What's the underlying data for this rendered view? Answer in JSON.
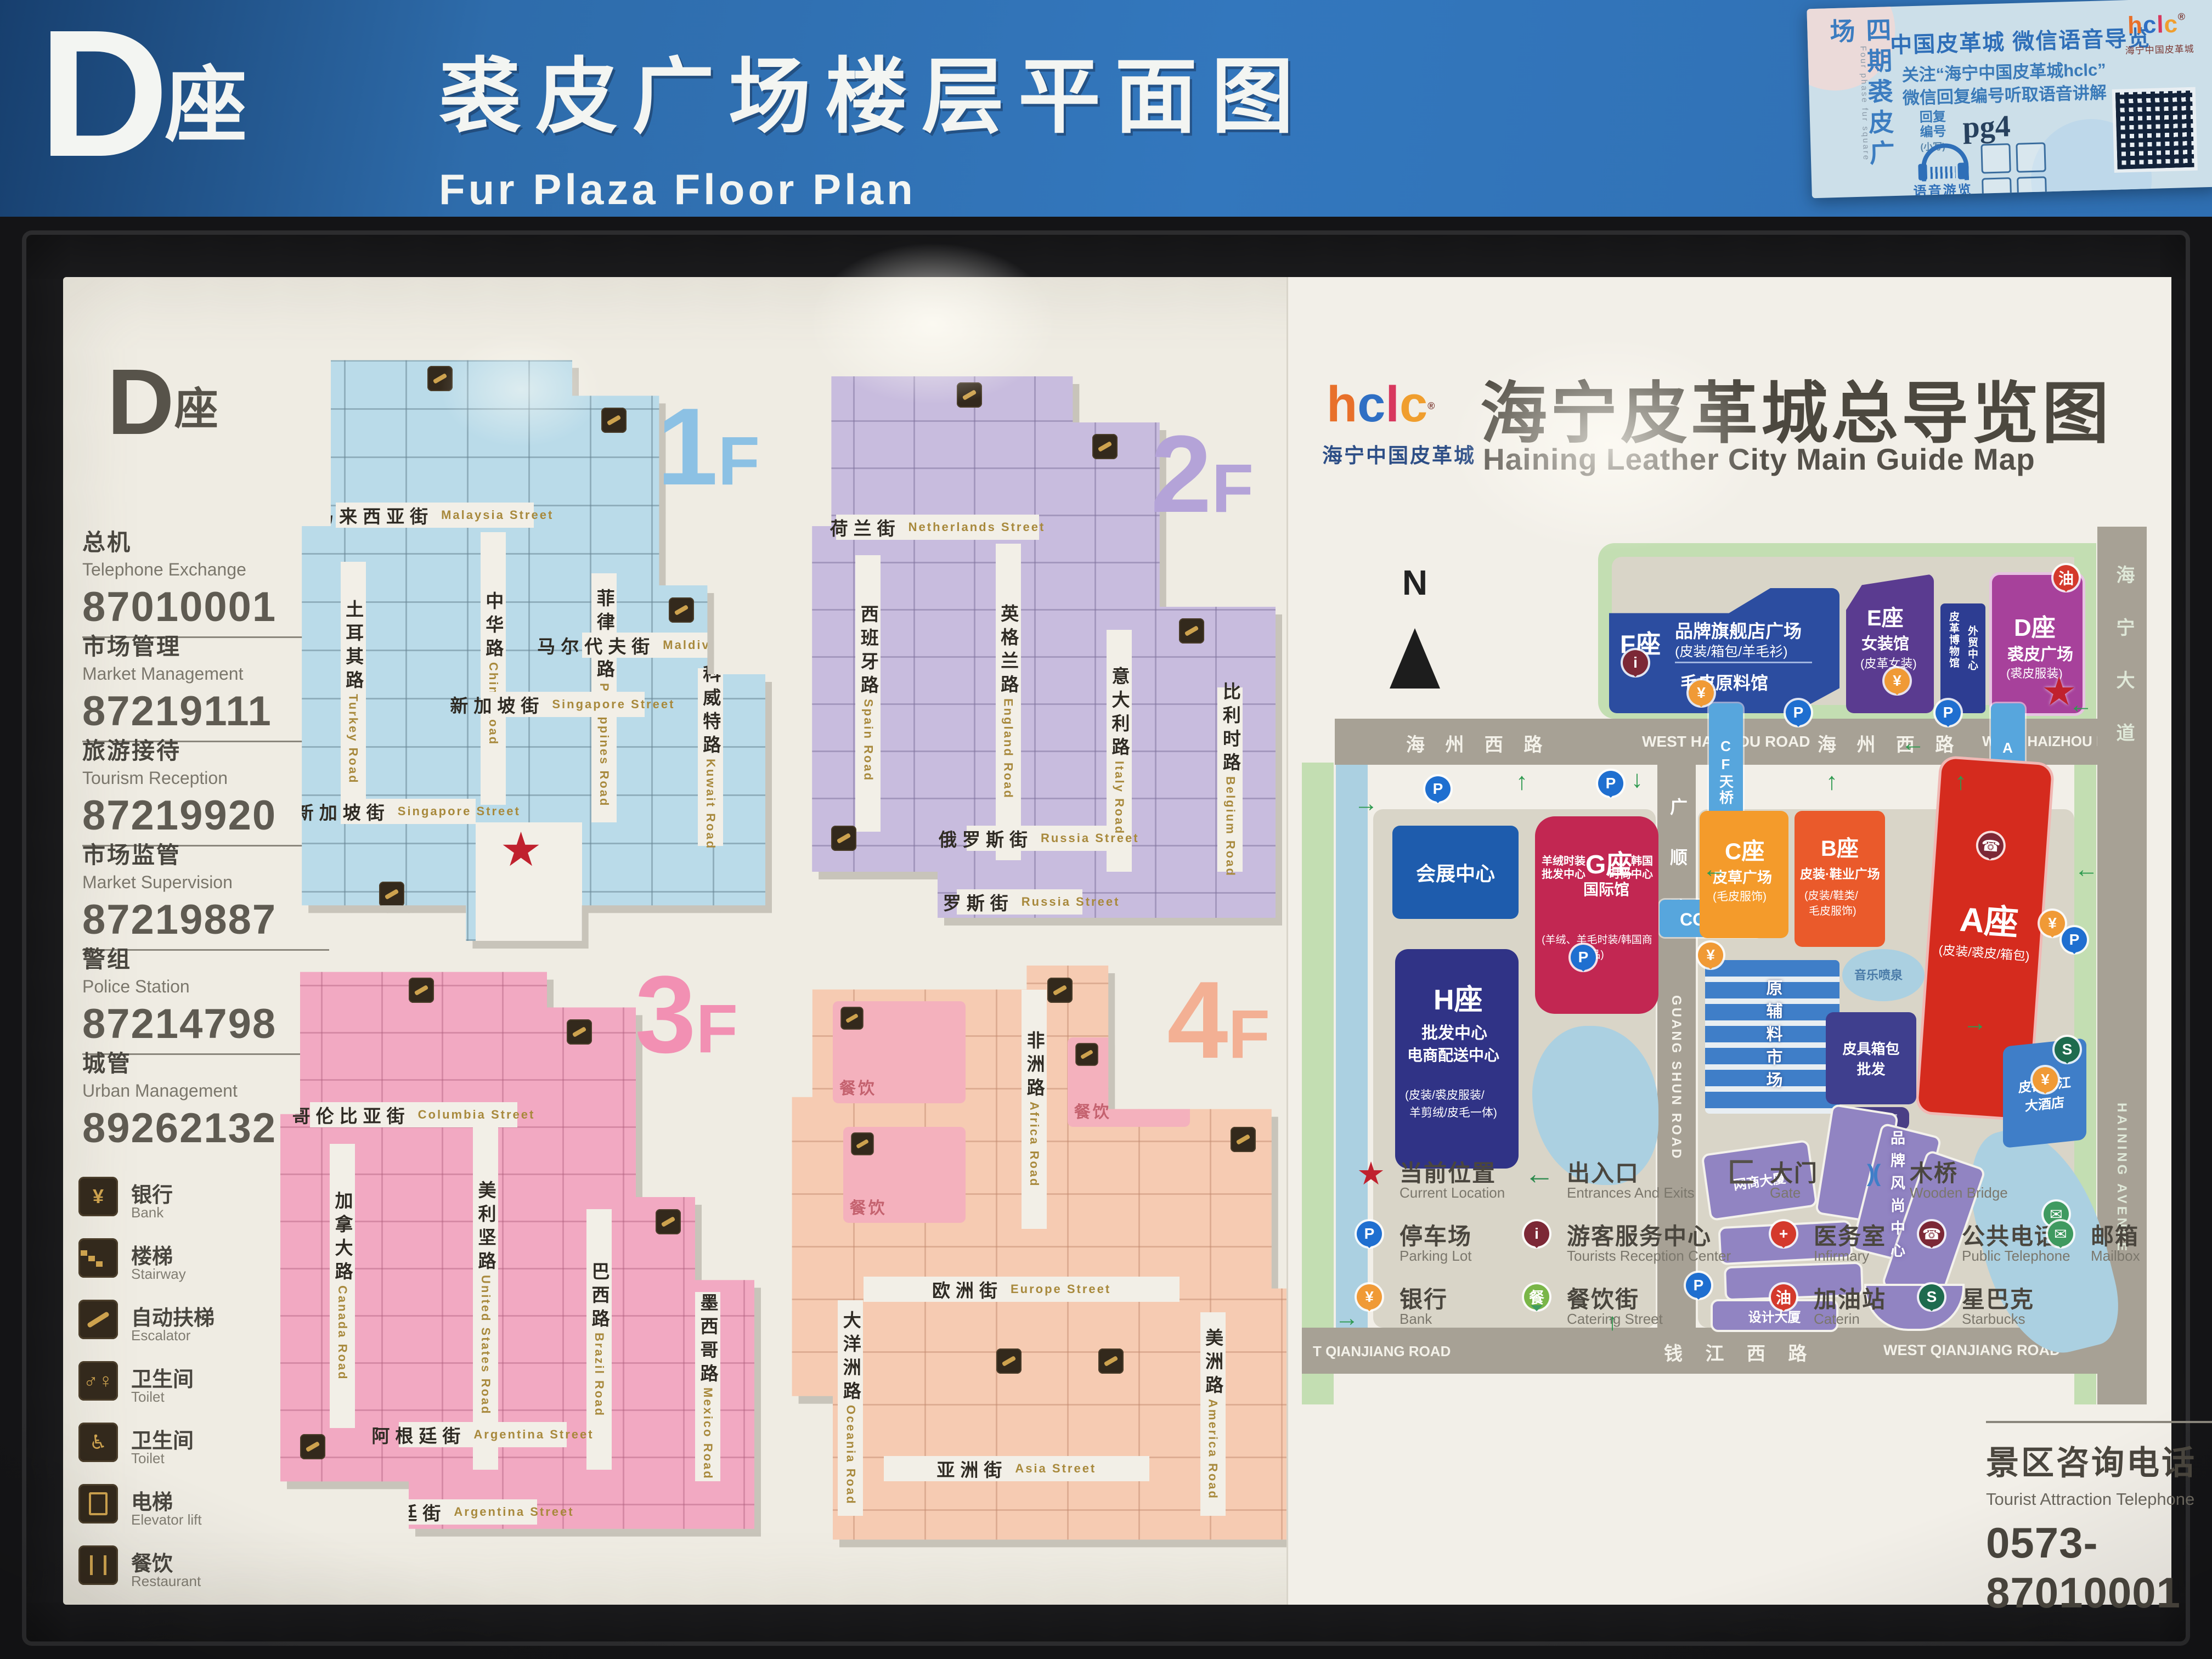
{
  "header": {
    "letter": "D",
    "suffix": "座",
    "title_zh": "裘皮广场楼层平面图",
    "title_en": "Fur Plaza  Floor Plan"
  },
  "brand": {
    "chars": [
      "h",
      "c",
      "l",
      "c"
    ],
    "reg": "®",
    "name_zh": "海宁中国皮革城"
  },
  "info_card": {
    "side_zh": "四期裘皮广场",
    "side_en": "Four  phase  fur  square",
    "title": "中国皮革城 微信语音导览",
    "line1": "关注“海宁中国皮革城hclc”",
    "line2": "微信回复编号听取语音讲解",
    "reply1": "回复",
    "reply2": "编号",
    "note": "(小写)",
    "code": "pg4",
    "audio": "语音游览"
  },
  "sidebar": {
    "letter": "D",
    "suffix": "座",
    "contacts": [
      {
        "zh": "总机",
        "en": "Telephone Exchange",
        "tel": "87010001"
      },
      {
        "zh": "市场管理",
        "en": "Market Management",
        "tel": "87219111"
      },
      {
        "zh": "旅游接待",
        "en": "Tourism Reception",
        "tel": "87219920"
      },
      {
        "zh": "市场监管",
        "en": "Market Supervision",
        "tel": "87219887"
      },
      {
        "zh": "警组",
        "en": "Police Station",
        "tel": "87214798"
      },
      {
        "zh": "城管",
        "en": "Urban Management",
        "tel": "89262132"
      }
    ],
    "legend": [
      {
        "zh": "银行",
        "en": "Bank"
      },
      {
        "zh": "楼梯",
        "en": "Stairway"
      },
      {
        "zh": "自动扶梯",
        "en": "Escalator"
      },
      {
        "zh": "卫生间",
        "en": "Toilet"
      },
      {
        "zh": "卫生间",
        "en": "Toilet"
      },
      {
        "zh": "电梯",
        "en": "Elevator lift"
      },
      {
        "zh": "餐饮",
        "en": "Restaurant"
      }
    ]
  },
  "floors": [
    {
      "num": "1",
      "suffix": "F",
      "streets": [
        {
          "zh": "马来西亚街",
          "en": "Malaysia Street"
        },
        {
          "zh": "土耳其路",
          "en": "Turkey Road"
        },
        {
          "zh": "中华路",
          "en": "China Road"
        },
        {
          "zh": "菲律宾路",
          "en": "Philippines Road"
        },
        {
          "zh": "马尔代夫街",
          "en": "Maldives Street"
        },
        {
          "zh": "科威特路",
          "en": "Kuwait Road"
        },
        {
          "zh": "新加坡街",
          "en": "Singapore Street"
        },
        {
          "zh": "新加坡街",
          "en": "Singapore Street"
        }
      ]
    },
    {
      "num": "2",
      "suffix": "F",
      "streets": [
        {
          "zh": "荷兰街",
          "en": "Netherlands Street"
        },
        {
          "zh": "西班牙路",
          "en": "Spain Road"
        },
        {
          "zh": "英格兰路",
          "en": "England Road"
        },
        {
          "zh": "意大利路",
          "en": "Italy Road"
        },
        {
          "zh": "比利时路",
          "en": "Belgium Road"
        },
        {
          "zh": "俄罗斯街",
          "en": "Russia Street"
        },
        {
          "zh": "俄罗斯街",
          "en": "Russia Street"
        }
      ]
    },
    {
      "num": "3",
      "suffix": "F",
      "streets": [
        {
          "zh": "哥伦比亚街",
          "en": "Columbia Street"
        },
        {
          "zh": "加拿大路",
          "en": "Canada Road"
        },
        {
          "zh": "美利坚路",
          "en": "United States Road"
        },
        {
          "zh": "巴西路",
          "en": "Brazil Road"
        },
        {
          "zh": "墨西哥路",
          "en": "Mexico Road"
        },
        {
          "zh": "阿根廷街",
          "en": "Argentina Street"
        },
        {
          "zh": "阿根廷街",
          "en": "Argentina Street"
        }
      ]
    },
    {
      "num": "4",
      "suffix": "F",
      "food_label": "餐饮",
      "streets": [
        {
          "zh": "非洲路",
          "en": "Africa Road"
        },
        {
          "zh": "欧洲街",
          "en": "Europe Street"
        },
        {
          "zh": "大洋洲路",
          "en": "Oceania Road"
        },
        {
          "zh": "美洲路",
          "en": "America Road"
        },
        {
          "zh": "亚洲街",
          "en": "Asia Street"
        }
      ]
    }
  ],
  "guide": {
    "title_zh": "海宁皮革城总导览图",
    "title_en": "Haining Leather City Main Guide Map",
    "north": "N",
    "roads": {
      "haizhou_zh": "海 州 西 路",
      "haizhou_en": "WEST HAIZHOU ROAD",
      "qianjiang_zh": "钱 江 西 路",
      "qianjiang_en": "WEST QIANJIANG ROAD",
      "qianjiang_partial": "T QIANJIANG ROAD",
      "guangshun_zh": "广 顺 路",
      "guangshun_en": "GUANG SHUN ROAD",
      "haining_zh": "海 宁 大 道",
      "haining_en": "HAINING AVENUE"
    },
    "bridges": {
      "cf": "CF天桥",
      "ad": "AD天桥",
      "cg": "CG天桥"
    },
    "buildings": {
      "f": {
        "name": "F座",
        "line1": "品牌旗舰店广场",
        "line2": "(皮装/箱包/羊毛衫)",
        "line3": "毛皮原料馆"
      },
      "e": {
        "name": "E座",
        "line1": "女装馆",
        "line2": "(皮革女装)"
      },
      "museum": {
        "line1": "皮革博物馆",
        "line2": "外贸中心"
      },
      "d": {
        "name": "D座",
        "line1": "裘皮广场",
        "line2": "(裘皮服装)"
      },
      "exhibition": {
        "name": "会展中心"
      },
      "g": {
        "name": "G座",
        "sub": "国际馆",
        "left1": "羊绒时装",
        "left2": "批发中心",
        "right1": "韩国",
        "right2": "时尚中心",
        "bottom": "(羊绒、羊毛时装/韩国商品)"
      },
      "h": {
        "name": "H座",
        "line1": "批发中心",
        "line2": "电商配送中心",
        "line3": "(皮装/裘皮服装/",
        "line4": "羊剪绒/皮毛一体)"
      },
      "c": {
        "name": "C座",
        "line1": "皮草广场",
        "line2": "(毛皮服饰)"
      },
      "b": {
        "name": "B座",
        "line1": "皮装·鞋业广场",
        "line2": "(皮装/鞋类/",
        "line3": "毛皮服饰)"
      },
      "a": {
        "name": "A座",
        "line1": "(皮装/裘皮/箱包)"
      },
      "materials": {
        "name": "原辅料市场"
      },
      "bags": {
        "name": "皮具箱包批发"
      },
      "lc_tower": {
        "name": "皮革城大厦"
      },
      "wangshang": {
        "name": "网商大厦"
      },
      "design": {
        "name": "设计大厦"
      },
      "brand_center": {
        "name": "品牌风尚中心"
      },
      "hotel1": {
        "name": "皮都锦江",
        "name2": "大酒店"
      },
      "fountain": {
        "name": "音乐喷泉"
      }
    },
    "legend": [
      {
        "zh": "当前位置",
        "en": "Current Location"
      },
      {
        "zh": "出入口",
        "en": "Entrances And Exits"
      },
      {
        "zh": "大门",
        "en": "Gate"
      },
      {
        "zh": "木桥",
        "en": "Wooden Bridge"
      },
      {
        "zh": "停车场",
        "en": "Parking Lot"
      },
      {
        "zh": "游客服务中心",
        "en": "Tourists Reception Center"
      },
      {
        "zh": "医务室",
        "en": "Infirmary"
      },
      {
        "zh": "公共电话",
        "en": "Public Telephone"
      },
      {
        "zh": "邮箱",
        "en": "Mailbox"
      },
      {
        "zh": "银行",
        "en": "Bank"
      },
      {
        "zh": "餐饮街",
        "en": "Catering Street"
      },
      {
        "zh": "加油站",
        "en": "Caterin"
      },
      {
        "zh": "星巴克",
        "en": "Starbucks"
      }
    ],
    "hotline": {
      "zh": "景区咨询电话",
      "en": "Tourist Attraction Telephone",
      "tel": "0573-87010001"
    }
  }
}
